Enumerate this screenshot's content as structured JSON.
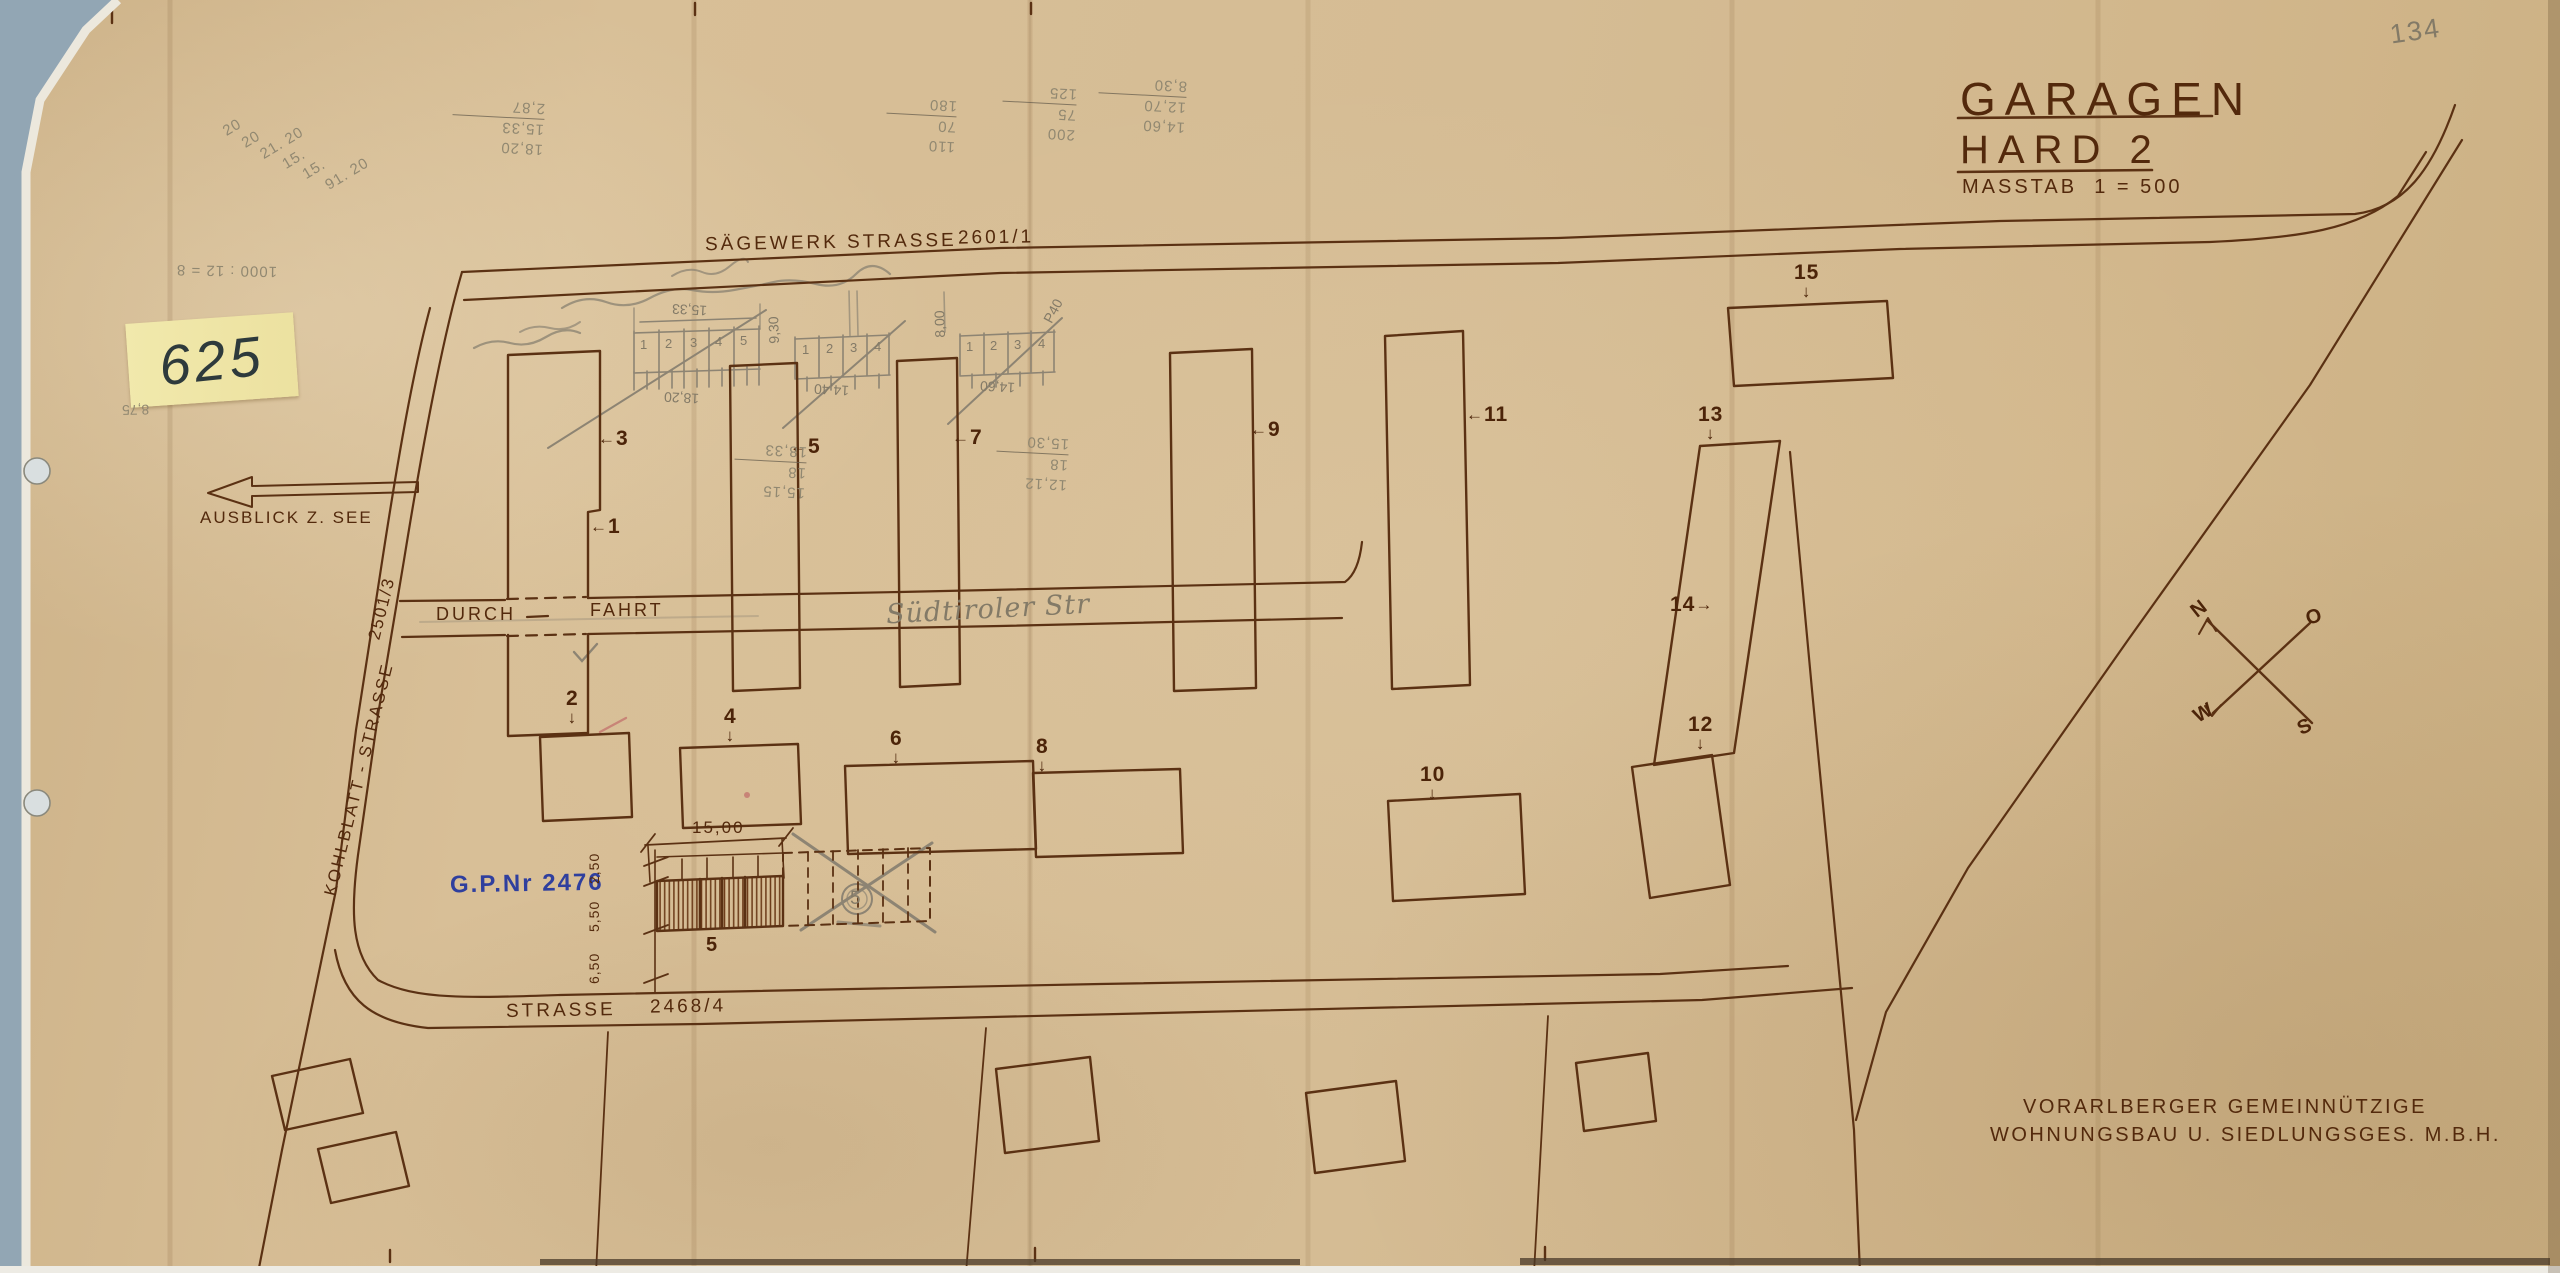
{
  "title": {
    "line1": "GARAGEN",
    "line2": "HARD 2",
    "scale_label": "MASSTAB",
    "scale_value": "1 = 500"
  },
  "corner_note": "134",
  "sticky": {
    "number": "625"
  },
  "arrow_note": "AUSBLICK Z. SEE",
  "streets": {
    "saegewerk": "SÄGEWERK STRASSE",
    "saegewerk_parcel": "2601/1",
    "kohlblatt": "KOHLBLATT - STRASSE",
    "kohlblatt_parcel": "2501/3",
    "south": "STRASSE",
    "south_parcel": "2468/4",
    "durch": "DURCH",
    "fahrt": "FAHRT",
    "suedtiroler": "Südtiroler Str"
  },
  "compass": {
    "n": "N",
    "e": "O",
    "s": "S",
    "w": "W"
  },
  "buildings": {
    "b1": "1",
    "b2": "2",
    "b3": "3",
    "b4": "4",
    "b5": "5",
    "b6": "6",
    "b7": "7",
    "b8": "8",
    "b9": "9",
    "b10": "10",
    "b11": "11",
    "b12": "12",
    "b13": "13",
    "b14": "14",
    "b15": "15"
  },
  "garage": {
    "gp": "G.P.Nr 2476",
    "dim_width": "15,00",
    "dim_a": "2,50",
    "dim_b": "5,50",
    "dim_c": "6,50",
    "label": "5",
    "crossed": "5"
  },
  "grids": {
    "a": {
      "cells": [
        "1",
        "2",
        "3",
        "4",
        "5"
      ],
      "top": "15,33",
      "bottom": "18,20"
    },
    "b": {
      "cells": [
        "1",
        "2",
        "3",
        "4"
      ],
      "left": "9,30",
      "bottom": "14,40"
    },
    "c": {
      "cells": [
        "1",
        "2",
        "3",
        "4"
      ],
      "left": "8,00",
      "bottom": "14,60",
      "note": "P40"
    }
  },
  "pencil": {
    "diag": [
      "20",
      "20",
      "21. 20",
      "15.",
      "15.",
      "91. 20"
    ],
    "calc1": [
      "110",
      "70",
      "180"
    ],
    "calc2": [
      "200",
      "75",
      "125"
    ],
    "calc3": [
      "14,60",
      "12,70",
      "8,30"
    ],
    "calc4": [
      "18,20",
      "15,33",
      "2,87"
    ],
    "calc5": [
      "15,15",
      "18",
      "18,33"
    ],
    "calc6": [
      "12,12",
      "18",
      "15,30"
    ],
    "division": "1000 : 12 = 8",
    "h875": "8,75"
  },
  "firm": {
    "line1": "VORARLBERGER GEMEINNÜTZIGE",
    "line2": "WOHNUNGSBAU U. SIEDLUNGSGES. M.B.H."
  }
}
